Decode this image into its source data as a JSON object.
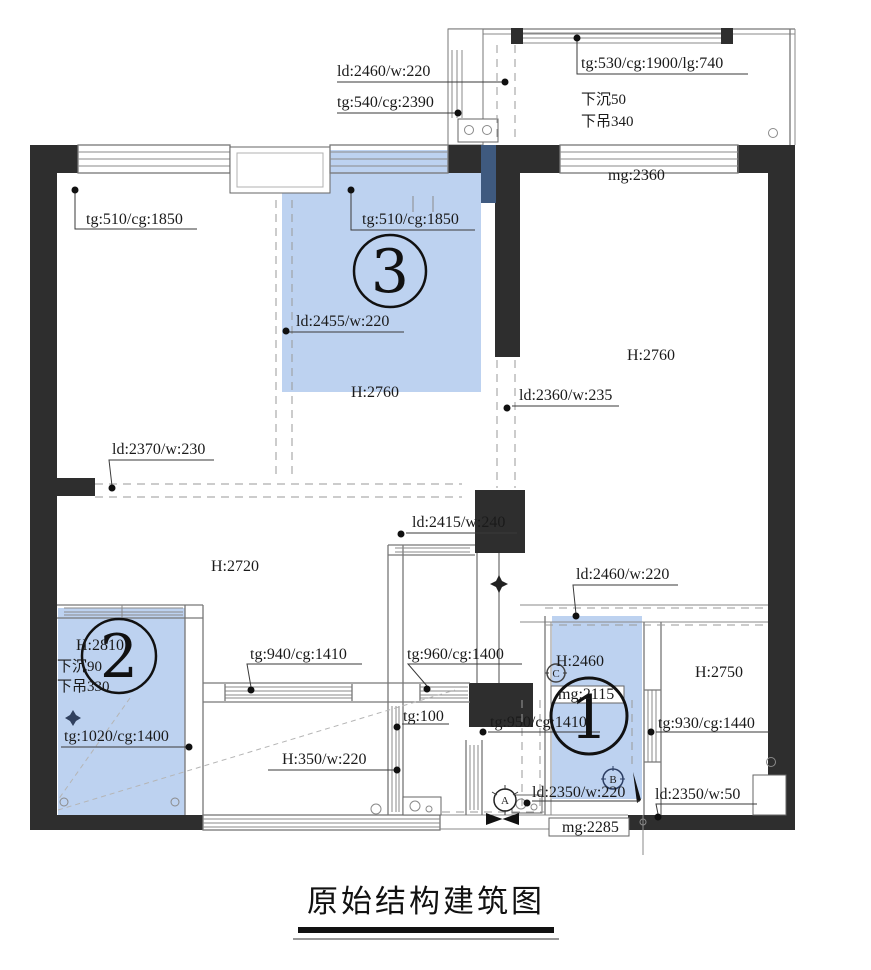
{
  "title": "原始结构建筑图",
  "colors": {
    "highlight": "#bdd2f0",
    "highlight_dark": "#3f5a7f",
    "wall": "#2e2e2e"
  },
  "regions": {
    "r1": "1",
    "r2": "2",
    "r3": "3"
  },
  "symbols": {
    "a": "A",
    "b": "B",
    "c": "C"
  },
  "labels": {
    "ld2460_top": "ld:2460/w:220",
    "tg540": "tg:540/cg:2390",
    "tg530": "tg:530/cg:1900/lg:740",
    "sink50": "下沉50",
    "ceiling340": "下吊340",
    "mg2360": "mg:2360",
    "tg510_left": "tg:510/cg:1850",
    "tg510_mid": "tg:510/cg:1850",
    "ld2455": "ld:2455/w:220",
    "h2760_mid": "H:2760",
    "ld2360": "ld:2360/w:235",
    "h2760_right": "H:2760",
    "ld2370": "ld:2370/w:230",
    "ld2415": "ld:2415/w:240",
    "h2720": "H:2720",
    "ld2460_right": "ld:2460/w:220",
    "h2460": "H:2460",
    "mg2115": "mg:2115",
    "h2750": "H:2750",
    "h2810": "H:2810",
    "sink90": "下沉90",
    "ceiling330": "下吊330",
    "tg1020": "tg:1020/cg:1400",
    "tg940": "tg:940/cg:1410",
    "tg960": "tg:960/cg:1400",
    "tg100": "tg:100",
    "h350": "H:350/w:220",
    "tg950": "tg:950/cg:1410",
    "tg930": "tg:930/cg:1440",
    "ld2350_220": "ld:2350/w:220",
    "ld2350_50": "ld:2350/w:50",
    "mg2285": "mg:2285"
  }
}
